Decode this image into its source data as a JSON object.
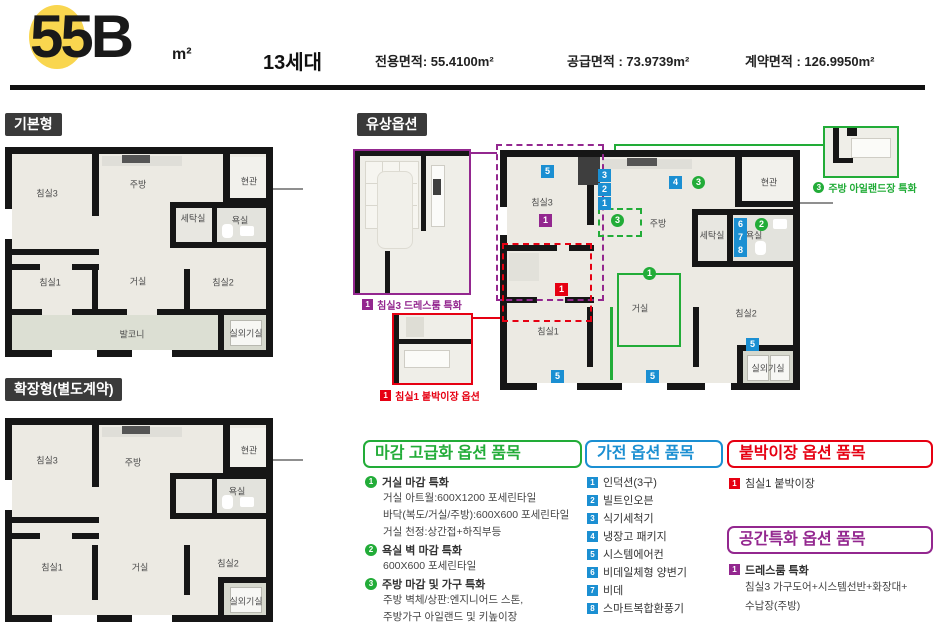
{
  "header": {
    "unit_code": "55B",
    "unit_unit": "m²",
    "households": "13세대",
    "area_specs": [
      "전용면적: 55.4100m²",
      "공급면적 : 73.9739m²",
      "계약면적 : 126.9950m²"
    ]
  },
  "section_labels": {
    "basic": "기본형",
    "extended": "확장형(별도계약)",
    "paid": "유상옵션"
  },
  "rooms": {
    "bed1": "침실1",
    "bed2": "침실2",
    "bed3": "침실3",
    "kitchen": "주방",
    "living": "거실",
    "entrance": "현관",
    "laundry": "세탁실",
    "bath": "욕실",
    "balcony": "발코니",
    "outdoor_unit": "실외기실"
  },
  "badges": {
    "1": "1",
    "2": "2",
    "3": "3",
    "4": "4",
    "5": "5",
    "6": "6",
    "7": "7",
    "8": "8"
  },
  "insets": {
    "dressroom": {
      "num": "1",
      "caption": "침실3 드레스룸 특화"
    },
    "closet": {
      "num": "1",
      "caption": "침실1 붙박이장 옵션"
    },
    "island": {
      "num": "3",
      "caption": "주방 아일랜드장 특화"
    }
  },
  "option_lists": {
    "finish": {
      "title": "마감 고급화 옵션 품목",
      "items": [
        {
          "num": "1",
          "title": "거실 마감 특화",
          "details": [
            "거실 아트월:600X1200 포세린타일",
            "바닥(복도/거실/주방):600X600 포세린타일",
            "거실 천정:상간접+하직부등"
          ]
        },
        {
          "num": "2",
          "title": "욕실 벽 마감 특화",
          "details": [
            "600X600 포세린타일"
          ]
        },
        {
          "num": "3",
          "title": "주방 마감 및 가구 특화",
          "details": [
            "주방 벽체/상판:엔지니어드 스톤,",
            "주방가구 아일랜드 및 키높이장"
          ]
        }
      ]
    },
    "appliance": {
      "title": "가전 옵션 품목",
      "items": [
        {
          "num": "1",
          "label": "인덕션(3구)"
        },
        {
          "num": "2",
          "label": "빌트인오븐"
        },
        {
          "num": "3",
          "label": "식기세척기"
        },
        {
          "num": "4",
          "label": "냉장고 패키지"
        },
        {
          "num": "5",
          "label": "시스템에어컨"
        },
        {
          "num": "6",
          "label": "비데일체형 양변기"
        },
        {
          "num": "7",
          "label": "비데"
        },
        {
          "num": "8",
          "label": "스마트복합환풍기"
        }
      ]
    },
    "builtin_closet": {
      "title": "붙박이장 옵션 품목",
      "items": [
        {
          "num": "1",
          "label": "침실1 붙박이장"
        }
      ]
    },
    "space": {
      "title": "공간특화 옵션 품목",
      "items": [
        {
          "num": "1",
          "title": "드레스룸 특화",
          "details": [
            "침실3 가구도어+시스템선반+화장대+",
            "수납장(주방)"
          ]
        }
      ]
    }
  },
  "colors": {
    "highlight_yellow": "#F9D64F",
    "green": "#22AC38",
    "blue": "#1B8FD2",
    "red": "#E60012",
    "purple": "#93278F"
  }
}
